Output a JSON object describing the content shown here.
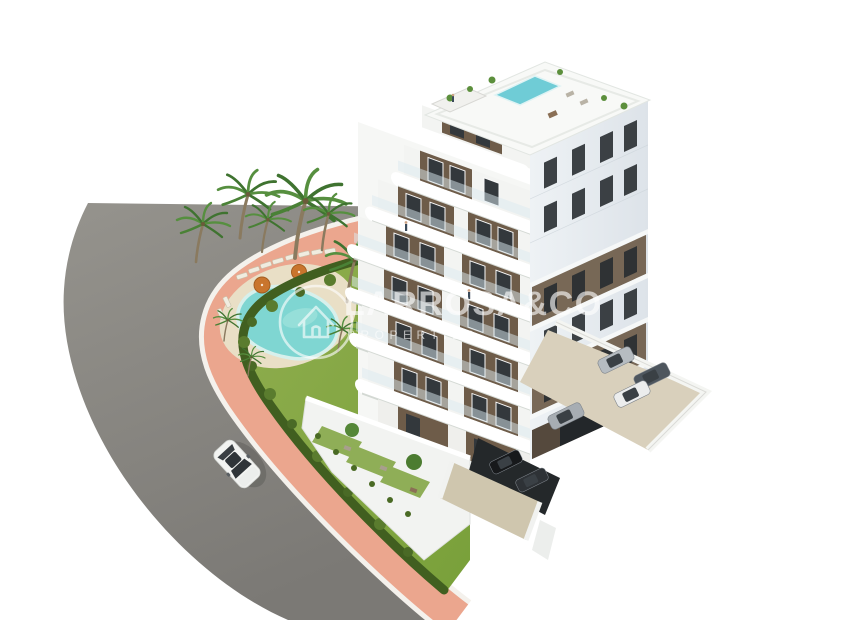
{
  "scene": {
    "type": "architectural-3d-render",
    "setting": "Aerial 3D render of a modern white apartment building with brown accents, rooftop plunge pool, communal kidney-shaped pool garden with palm trees, curved asphalt road with pink sidewalk, white car driving and parking area with cars",
    "watermark": {
      "title": "LARROSA&CO",
      "subtitle": "PROPERTIES",
      "logo": "house-in-circle"
    },
    "building": {
      "storeys_visible": 8,
      "style": "white curved balconies with dark brown window sections",
      "rooftop": "roof terrace with plunge pool, pergola and plants"
    },
    "vehicles": {
      "driving_car": "white sedan on road",
      "parked_cars": 6
    },
    "garden": {
      "pool_shape": "kidney",
      "sun_loungers": 10,
      "parasols": 2,
      "palm_trees": 9
    },
    "colors": {
      "background": "#ffffff",
      "road": "#8d8a85",
      "sidewalk": "#eba68e",
      "curb": "#f4f1ec",
      "lawn": "#84a744",
      "hedge": "#415f20",
      "pool_water": "#7fd6d2",
      "pool_deck": "#e9dfc6",
      "building_white": "#f6f7f5",
      "building_brown": "#6e5c49",
      "facade_shadow": "#e3e8ed",
      "window_dark": "#33383c",
      "rooftop_pool": "#6fccd6",
      "parking_ground": "#d9d0bc",
      "parasol": "#c9752d",
      "watermark": "#ffffff"
    }
  }
}
